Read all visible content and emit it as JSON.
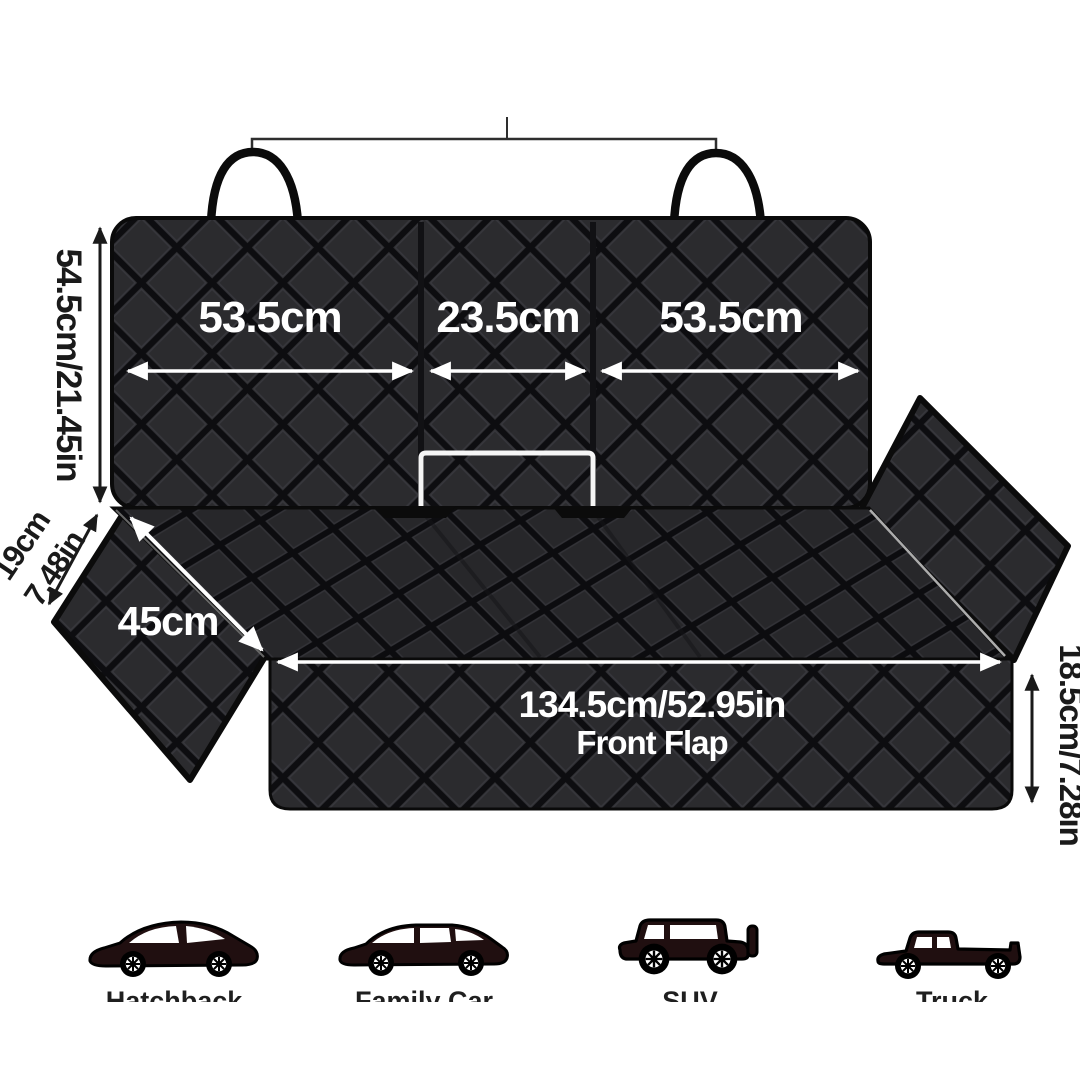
{
  "dimensions": {
    "back_width_left": "53.5cm",
    "back_width_middle": "23.5cm",
    "back_width_right": "53.5cm",
    "back_height": "54.5cm/21.45in",
    "side_flap_cm": "19cm",
    "side_flap_in": "7.48in",
    "seat_side": "45cm",
    "front_width": "134.5cm/52.95in",
    "front_flap_label": "Front Flap",
    "front_height": "18.5cm/7.28in"
  },
  "vehicles": [
    {
      "label": "Hatchback"
    },
    {
      "label": "Family Car"
    },
    {
      "label": "SUV"
    },
    {
      "label": "Truck"
    }
  ],
  "colors": {
    "background": "#ffffff",
    "fabric": "#2b2b2e",
    "fabric_groove": "#0d0d10",
    "stitch_highlight": "#44444a",
    "dimension_white": "#ffffff",
    "dimension_black": "#1a1a1a",
    "vehicle_body": "#200f10",
    "seat_edge_highlight": "#c9c9c9"
  }
}
